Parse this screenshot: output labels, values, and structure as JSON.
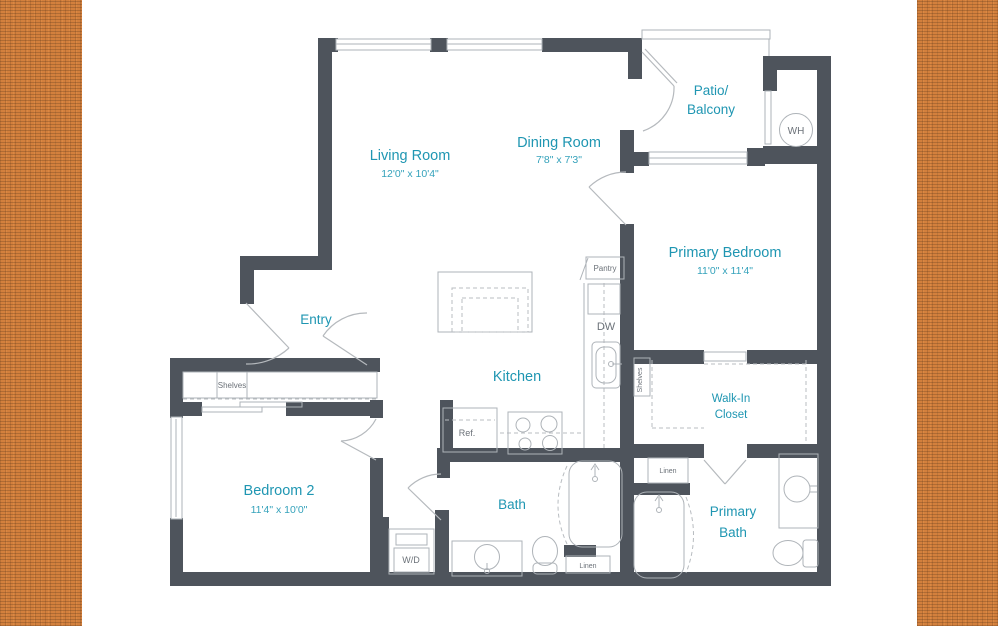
{
  "floorplan": {
    "rooms": {
      "living_room": {
        "name": "Living Room",
        "dims": "12'0\" x 10'4\""
      },
      "dining_room": {
        "name": "Dining Room",
        "dims": "7'8\" x 7'3\""
      },
      "patio": {
        "line1": "Patio/",
        "line2": "Balcony"
      },
      "primary_bedroom": {
        "name": "Primary Bedroom",
        "dims": "11'0\" x 11'4\""
      },
      "entry": {
        "name": "Entry"
      },
      "kitchen": {
        "name": "Kitchen"
      },
      "walk_in_closet": {
        "line1": "Walk-In",
        "line2": "Closet"
      },
      "bedroom_2": {
        "name": "Bedroom 2",
        "dims": "11'4\" x 10'0\""
      },
      "bath": {
        "name": "Bath"
      },
      "primary_bath": {
        "line1": "Primary",
        "line2": "Bath"
      }
    },
    "fixtures": {
      "water_heater": "WH",
      "pantry": "Pantry",
      "dishwasher": "DW",
      "closet_shelves": "Shelves",
      "walk_in_shelves": "Shelves",
      "refrigerator": "Ref.",
      "washer_dryer": "W/D",
      "linen_primary": "Linen",
      "linen_bath": "Linen"
    },
    "colors": {
      "room_label": "#1f96b2",
      "dims_label": "#35a2bb",
      "wall": "#4e545c",
      "fixture_line": "#aeb3b8",
      "fixture_text": "#6b7178",
      "border_texture": "#d3803d"
    }
  }
}
